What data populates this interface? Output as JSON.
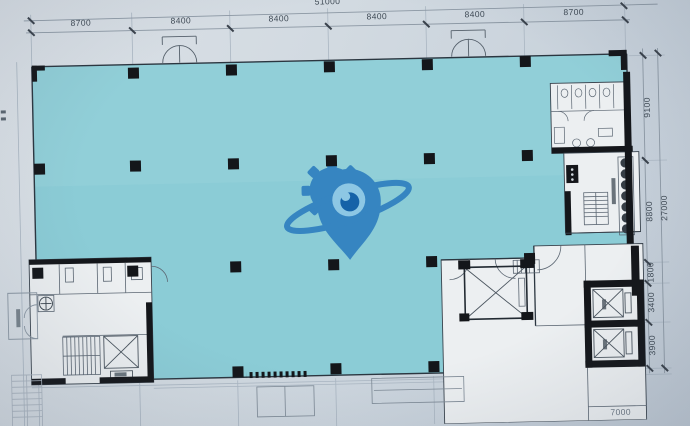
{
  "dimensions": {
    "top_total": "51000",
    "top": [
      "8700",
      "8400",
      "8400",
      "8400",
      "8400",
      "8700"
    ],
    "right": [
      "9100",
      "8800",
      "1800",
      "3400",
      "3900"
    ],
    "right_total": "27000",
    "bottom_partial": "7000"
  },
  "colors": {
    "paper": "#cfd7df",
    "floor": "#84c9d4",
    "floor_light": "#9ad4dc",
    "wall": "#14161a",
    "line_faint": "#a7b2bd",
    "line_mid": "#5c6773",
    "dim_text": "#3e4954",
    "watermark_blue": "#2f7fc0",
    "watermark_inner": "#8ec7e6",
    "watermark_eye": "#0c5aa5"
  },
  "watermark": {
    "icon": "gear-location-pin-orbit-logo"
  },
  "plan": {
    "grid_x": [
      35,
      136,
      234,
      332,
      430,
      528,
      629
    ],
    "grid_y": [
      62,
      167,
      269,
      290,
      329,
      375
    ],
    "columns": [
      [
        136,
        68
      ],
      [
        234,
        67
      ],
      [
        332,
        66
      ],
      [
        430,
        66
      ],
      [
        528,
        65
      ],
      [
        40,
        162
      ],
      [
        136,
        161
      ],
      [
        234,
        161
      ],
      [
        332,
        160
      ],
      [
        430,
        160
      ],
      [
        528,
        159
      ],
      [
        36,
        266
      ],
      [
        131,
        266
      ],
      [
        234,
        264
      ],
      [
        332,
        264
      ],
      [
        430,
        263
      ],
      [
        528,
        262
      ],
      [
        234,
        369
      ],
      [
        332,
        368
      ],
      [
        430,
        368
      ]
    ]
  }
}
